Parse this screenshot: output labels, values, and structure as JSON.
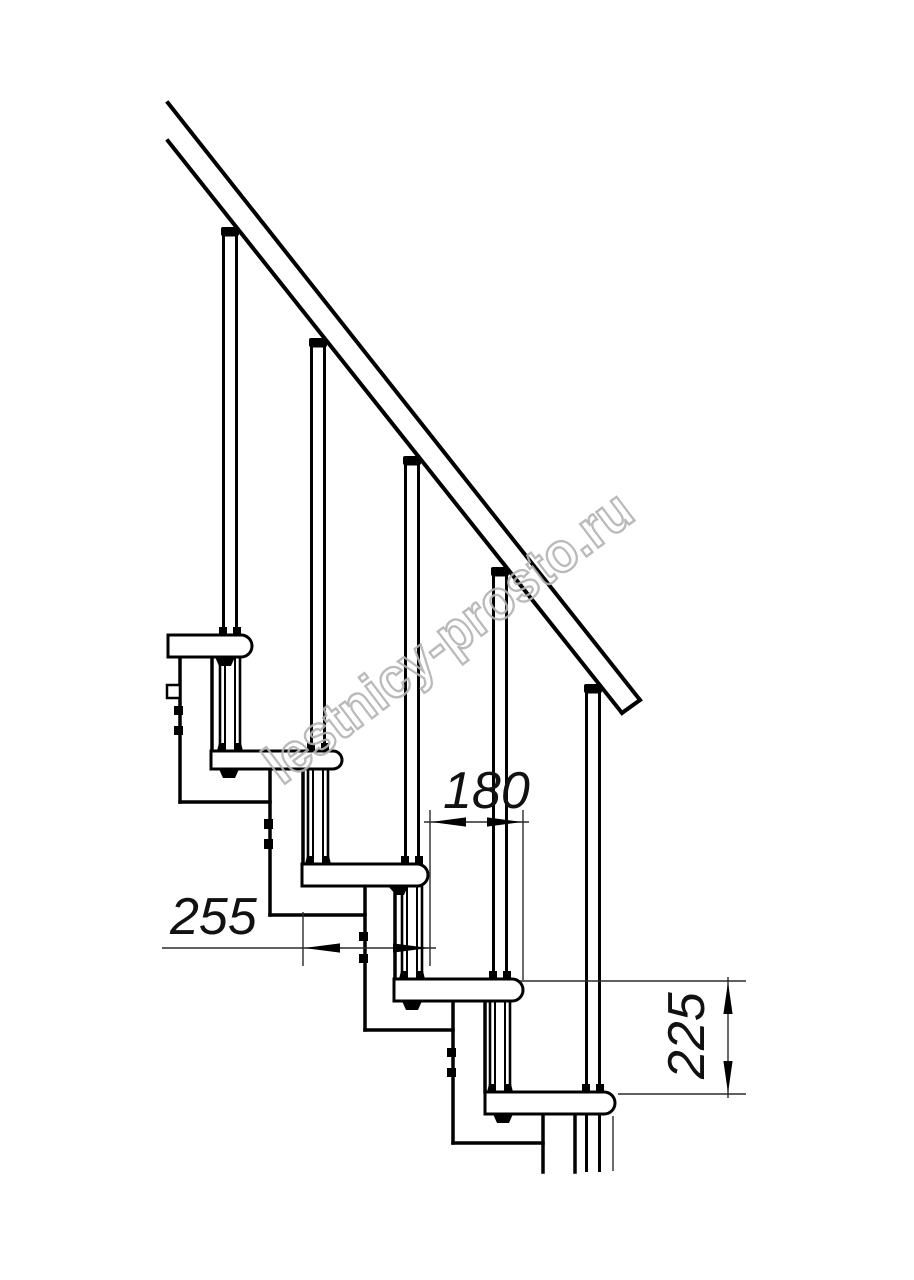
{
  "drawing": {
    "dimensions": {
      "tread_depth_mm": "255",
      "step_run_mm": "180",
      "step_rise_mm": "225"
    },
    "watermark": {
      "text": "lestnicy-prosto.ru",
      "color": "#b3b3b3"
    },
    "colors": {
      "line": "#000000",
      "background": "#ffffff",
      "dimension_line": "#2b2b2b"
    },
    "structure": {
      "view": "stair side elevation",
      "treads_visible": 5,
      "balusters_visible": 5,
      "support_modules_visible": 5,
      "handrails_visible": 1
    }
  }
}
